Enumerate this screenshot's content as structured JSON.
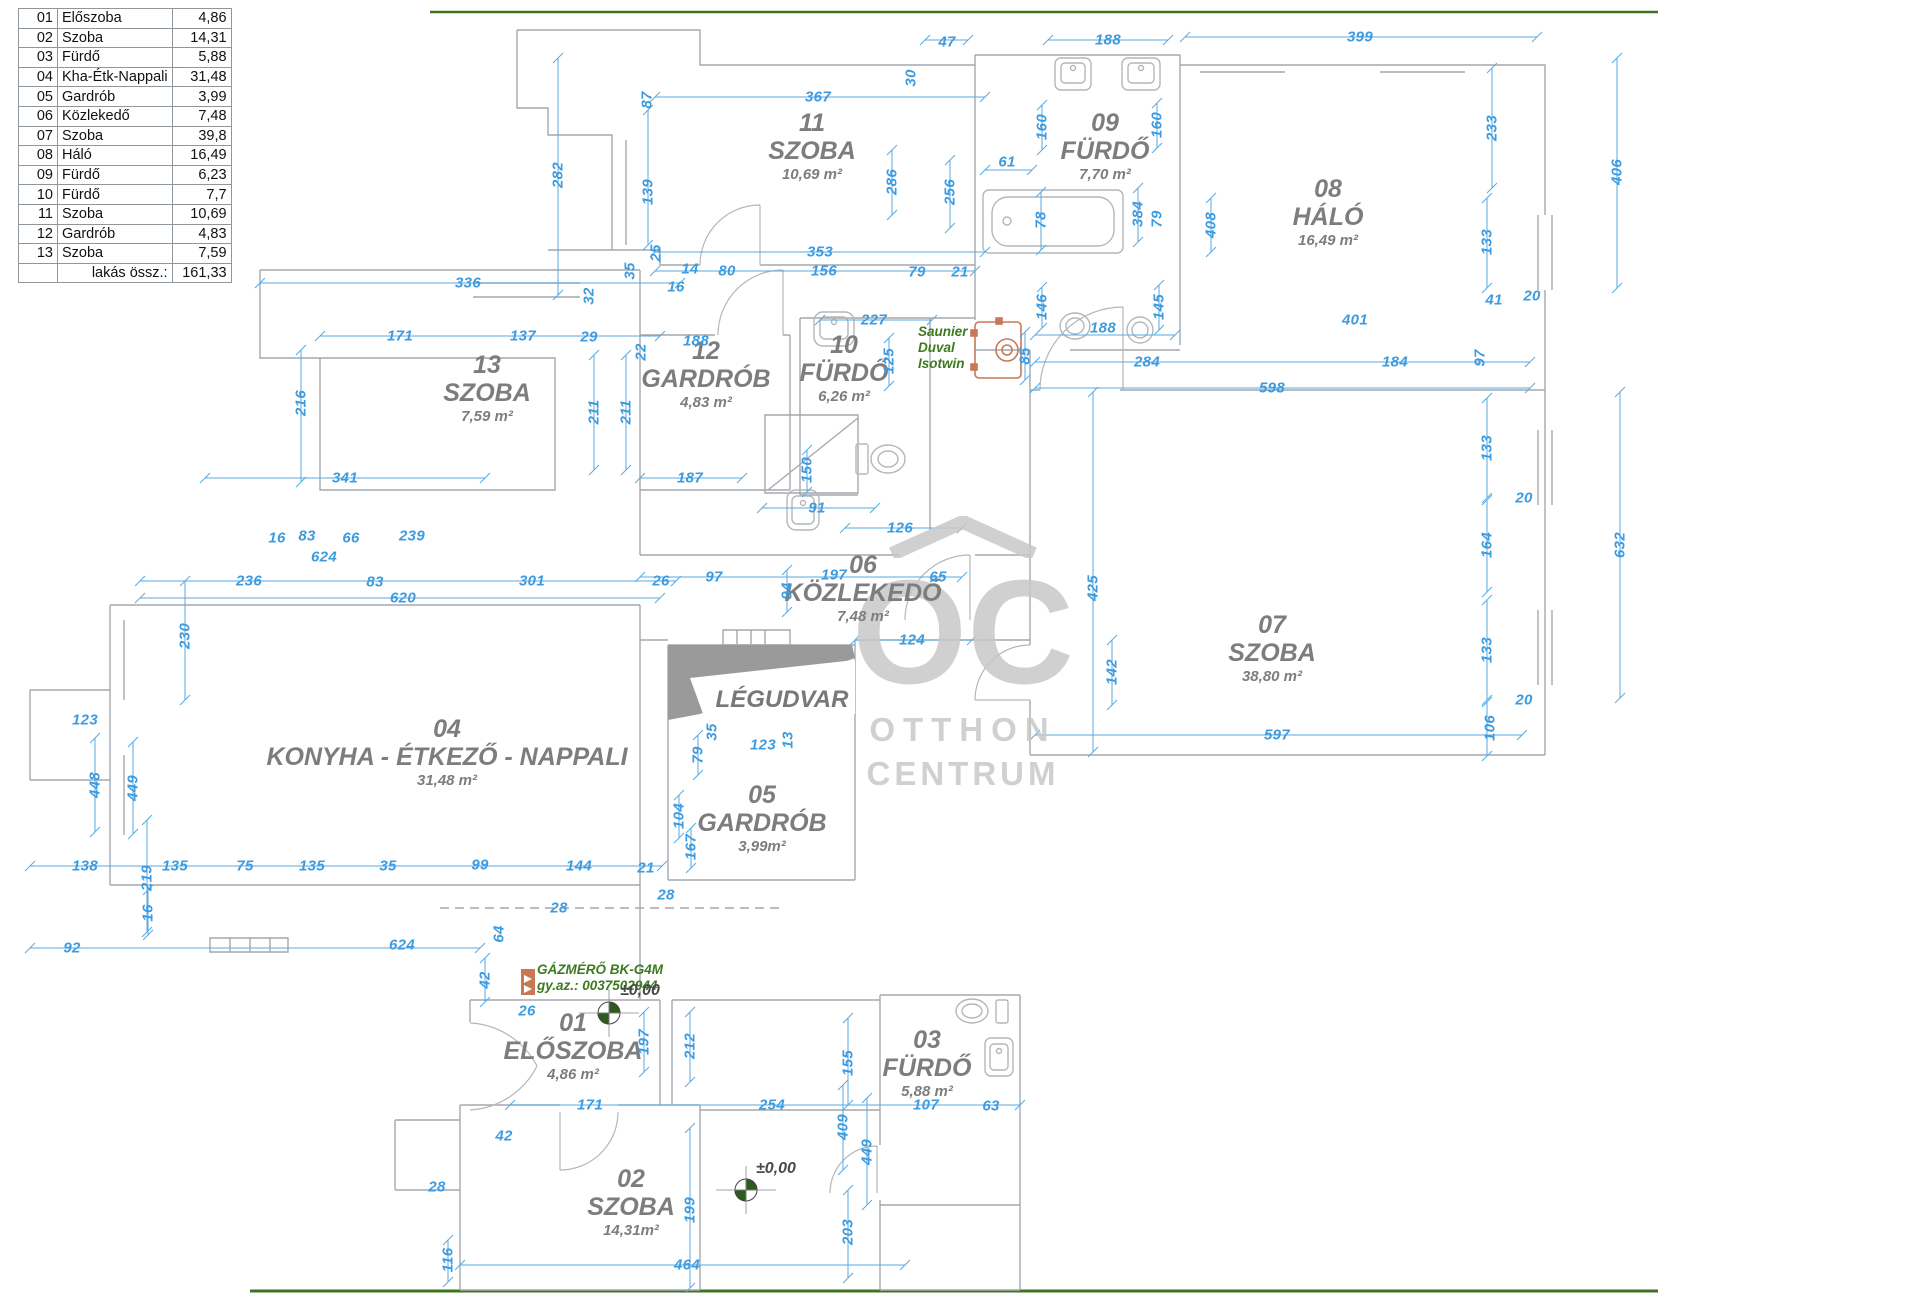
{
  "colors": {
    "dimension": "#3d9be0",
    "dim_line": "#5aaae2",
    "wall": "#a4a9ad",
    "fixture": "#b3b7b9",
    "room_label": "#7d7d7d",
    "green_text": "#3c7a1e",
    "orange": "#c97856",
    "watermark": "#c8c8c8",
    "border_green": "#3f7320",
    "marker_green": "#2d5a1d"
  },
  "table": {
    "rows": [
      {
        "no": "01",
        "name": "Előszoba",
        "area": "4,86"
      },
      {
        "no": "02",
        "name": "Szoba",
        "area": "14,31"
      },
      {
        "no": "03",
        "name": "Fürdő",
        "area": "5,88"
      },
      {
        "no": "04",
        "name": "Kha-Étk-Nappali",
        "area": "31,48"
      },
      {
        "no": "05",
        "name": "Gardrób",
        "area": "3,99"
      },
      {
        "no": "06",
        "name": "Közlekedő",
        "area": "7,48"
      },
      {
        "no": "07",
        "name": "Szoba",
        "area": "39,8"
      },
      {
        "no": "08",
        "name": "Háló",
        "area": "16,49"
      },
      {
        "no": "09",
        "name": "Fürdő",
        "area": "6,23"
      },
      {
        "no": "10",
        "name": "Fürdő",
        "area": "7,7"
      },
      {
        "no": "11",
        "name": "Szoba",
        "area": "10,69"
      },
      {
        "no": "12",
        "name": "Gardrób",
        "area": "4,83"
      },
      {
        "no": "13",
        "name": "Szoba",
        "area": "7,59"
      }
    ],
    "total_label": "lakás össz.:",
    "total_value": "161,33"
  },
  "rooms": [
    {
      "number": "11",
      "name": "SZOBA",
      "area": "10,69 m²",
      "x": 812,
      "y": 110
    },
    {
      "number": "09",
      "name": "FÜRDŐ",
      "area": "7,70 m²",
      "x": 1105,
      "y": 110
    },
    {
      "number": "08",
      "name": "HÁLÓ",
      "area": "16,49 m²",
      "x": 1328,
      "y": 176
    },
    {
      "number": "13",
      "name": "SZOBA",
      "area": "7,59 m²",
      "x": 487,
      "y": 352
    },
    {
      "number": "12",
      "name": "GARDRÓB",
      "area": "4,83 m²",
      "x": 706,
      "y": 338
    },
    {
      "number": "10",
      "name": "FÜRDŐ",
      "area": "6,26 m²",
      "x": 844,
      "y": 332
    },
    {
      "number": "06",
      "name": "KÖZLEKEDŐ",
      "area": "7,48 m²",
      "x": 863,
      "y": 552
    },
    {
      "number": "07",
      "name": "SZOBA",
      "area": "38,80 m²",
      "x": 1272,
      "y": 612
    },
    {
      "number": "04",
      "name": "KONYHA - ÉTKEZŐ - NAPPALI",
      "area": "31,48 m²",
      "x": 447,
      "y": 716
    },
    {
      "number": "05",
      "name": "GARDRÓB",
      "area": "3,99m²",
      "x": 762,
      "y": 782
    },
    {
      "number": "01",
      "name": "ELŐSZOBA",
      "area": "4,86 m²",
      "x": 573,
      "y": 1010
    },
    {
      "number": "03",
      "name": "FÜRDŐ",
      "area": "5,88 m²",
      "x": 927,
      "y": 1027
    },
    {
      "number": "02",
      "name": "SZOBA",
      "area": "14,31m²",
      "x": 631,
      "y": 1166
    }
  ],
  "legudvar": {
    "label": "LÉGUDVAR",
    "x": 782,
    "y": 700
  },
  "watermark": {
    "logo": "OC",
    "line1": "OTTHON",
    "line2": "CENTRUM"
  },
  "green_notes": [
    {
      "lines": [
        "Saunier",
        "Duval",
        "Isotwin"
      ],
      "x": 918,
      "y": 324
    },
    {
      "lines": [
        "GÁZMÉRŐ BK-G4M",
        "gy.az.: 0037502944"
      ],
      "x": 537,
      "y": 962
    }
  ],
  "level_markers": [
    {
      "label": "±0,00",
      "tx": 620,
      "ty": 982,
      "cx": 609,
      "cy": 1013
    },
    {
      "label": "±0,00",
      "tx": 756,
      "ty": 1160,
      "cx": 746,
      "cy": 1190
    }
  ],
  "dimensions": [
    {
      "t": "47",
      "x": 947,
      "y": 42,
      "o": "h"
    },
    {
      "t": "30",
      "x": 911,
      "y": 78,
      "o": "v"
    },
    {
      "t": "188",
      "x": 1108,
      "y": 40,
      "o": "h"
    },
    {
      "t": "399",
      "x": 1360,
      "y": 37,
      "o": "h"
    },
    {
      "t": "87",
      "x": 647,
      "y": 100,
      "o": "v"
    },
    {
      "t": "367",
      "x": 818,
      "y": 97,
      "o": "h"
    },
    {
      "t": "282",
      "x": 558,
      "y": 175,
      "o": "v"
    },
    {
      "t": "139",
      "x": 648,
      "y": 192,
      "o": "v"
    },
    {
      "t": "286",
      "x": 892,
      "y": 182,
      "o": "v"
    },
    {
      "t": "256",
      "x": 950,
      "y": 192,
      "o": "v"
    },
    {
      "t": "160",
      "x": 1042,
      "y": 127,
      "o": "v"
    },
    {
      "t": "160",
      "x": 1157,
      "y": 125,
      "o": "v"
    },
    {
      "t": "61",
      "x": 1007,
      "y": 162,
      "o": "h"
    },
    {
      "t": "78",
      "x": 1041,
      "y": 220,
      "o": "v"
    },
    {
      "t": "384",
      "x": 1138,
      "y": 214,
      "o": "v"
    },
    {
      "t": "79",
      "x": 1157,
      "y": 219,
      "o": "v"
    },
    {
      "t": "408",
      "x": 1211,
      "y": 225,
      "o": "v"
    },
    {
      "t": "406",
      "x": 1617,
      "y": 172,
      "o": "v"
    },
    {
      "t": "233",
      "x": 1492,
      "y": 128,
      "o": "v"
    },
    {
      "t": "133",
      "x": 1487,
      "y": 242,
      "o": "v"
    },
    {
      "t": "146",
      "x": 1042,
      "y": 307,
      "o": "v"
    },
    {
      "t": "145",
      "x": 1159,
      "y": 307,
      "o": "v"
    },
    {
      "t": "188",
      "x": 1103,
      "y": 328,
      "o": "h"
    },
    {
      "t": "85",
      "x": 1025,
      "y": 356,
      "o": "v"
    },
    {
      "t": "284",
      "x": 1147,
      "y": 362,
      "o": "h"
    },
    {
      "t": "401",
      "x": 1355,
      "y": 320,
      "o": "h"
    },
    {
      "t": "41",
      "x": 1494,
      "y": 300,
      "o": "h"
    },
    {
      "t": "20",
      "x": 1532,
      "y": 296,
      "o": "h"
    },
    {
      "t": "184",
      "x": 1395,
      "y": 362,
      "o": "h"
    },
    {
      "t": "97",
      "x": 1480,
      "y": 358,
      "o": "v"
    },
    {
      "t": "598",
      "x": 1272,
      "y": 388,
      "o": "h"
    },
    {
      "t": "353",
      "x": 820,
      "y": 252,
      "o": "h"
    },
    {
      "t": "156",
      "x": 824,
      "y": 271,
      "o": "h"
    },
    {
      "t": "79",
      "x": 917,
      "y": 272,
      "o": "h"
    },
    {
      "t": "21",
      "x": 960,
      "y": 272,
      "o": "h"
    },
    {
      "t": "80",
      "x": 727,
      "y": 271,
      "o": "h"
    },
    {
      "t": "14",
      "x": 690,
      "y": 269,
      "o": "h"
    },
    {
      "t": "16",
      "x": 676,
      "y": 287,
      "o": "h"
    },
    {
      "t": "25",
      "x": 656,
      "y": 253,
      "o": "v"
    },
    {
      "t": "35",
      "x": 630,
      "y": 271,
      "o": "v"
    },
    {
      "t": "227",
      "x": 874,
      "y": 320,
      "o": "h"
    },
    {
      "t": "125",
      "x": 889,
      "y": 361,
      "o": "v"
    },
    {
      "t": "336",
      "x": 468,
      "y": 283,
      "o": "h"
    },
    {
      "t": "32",
      "x": 589,
      "y": 296,
      "o": "v"
    },
    {
      "t": "29",
      "x": 589,
      "y": 337,
      "o": "h"
    },
    {
      "t": "171",
      "x": 400,
      "y": 336,
      "o": "h"
    },
    {
      "t": "137",
      "x": 523,
      "y": 336,
      "o": "h"
    },
    {
      "t": "216",
      "x": 301,
      "y": 403,
      "o": "v"
    },
    {
      "t": "211",
      "x": 594,
      "y": 412,
      "o": "v"
    },
    {
      "t": "211",
      "x": 626,
      "y": 412,
      "o": "v"
    },
    {
      "t": "188",
      "x": 696,
      "y": 341,
      "o": "h"
    },
    {
      "t": "22",
      "x": 641,
      "y": 352,
      "o": "v"
    },
    {
      "t": "341",
      "x": 345,
      "y": 478,
      "o": "h"
    },
    {
      "t": "187",
      "x": 690,
      "y": 478,
      "o": "h"
    },
    {
      "t": "16",
      "x": 277,
      "y": 538,
      "o": "h"
    },
    {
      "t": "83",
      "x": 307,
      "y": 536,
      "o": "h"
    },
    {
      "t": "66",
      "x": 351,
      "y": 538,
      "o": "h"
    },
    {
      "t": "239",
      "x": 412,
      "y": 536,
      "o": "h"
    },
    {
      "t": "624",
      "x": 324,
      "y": 557,
      "o": "h"
    },
    {
      "t": "236",
      "x": 249,
      "y": 581,
      "o": "h"
    },
    {
      "t": "83",
      "x": 375,
      "y": 582,
      "o": "h"
    },
    {
      "t": "301",
      "x": 532,
      "y": 581,
      "o": "h"
    },
    {
      "t": "26",
      "x": 661,
      "y": 581,
      "o": "h"
    },
    {
      "t": "97",
      "x": 714,
      "y": 577,
      "o": "h"
    },
    {
      "t": "620",
      "x": 403,
      "y": 598,
      "o": "h"
    },
    {
      "t": "197",
      "x": 834,
      "y": 575,
      "o": "h"
    },
    {
      "t": "65",
      "x": 938,
      "y": 577,
      "o": "h"
    },
    {
      "t": "94",
      "x": 787,
      "y": 591,
      "o": "v"
    },
    {
      "t": "91",
      "x": 817,
      "y": 508,
      "o": "h"
    },
    {
      "t": "150",
      "x": 807,
      "y": 470,
      "o": "v"
    },
    {
      "t": "126",
      "x": 900,
      "y": 528,
      "o": "h"
    },
    {
      "t": "124",
      "x": 912,
      "y": 640,
      "o": "h"
    },
    {
      "t": "425",
      "x": 1093,
      "y": 588,
      "o": "v"
    },
    {
      "t": "142",
      "x": 1112,
      "y": 672,
      "o": "v"
    },
    {
      "t": "597",
      "x": 1277,
      "y": 735,
      "o": "h"
    },
    {
      "t": "106",
      "x": 1490,
      "y": 728,
      "o": "v"
    },
    {
      "t": "20",
      "x": 1524,
      "y": 700,
      "o": "h"
    },
    {
      "t": "133",
      "x": 1487,
      "y": 650,
      "o": "v"
    },
    {
      "t": "164",
      "x": 1487,
      "y": 545,
      "o": "v"
    },
    {
      "t": "20",
      "x": 1524,
      "y": 498,
      "o": "h"
    },
    {
      "t": "133",
      "x": 1487,
      "y": 448,
      "o": "v"
    },
    {
      "t": "632",
      "x": 1620,
      "y": 545,
      "o": "v"
    },
    {
      "t": "123",
      "x": 85,
      "y": 720,
      "o": "h"
    },
    {
      "t": "448",
      "x": 95,
      "y": 785,
      "o": "v"
    },
    {
      "t": "449",
      "x": 133,
      "y": 788,
      "o": "v"
    },
    {
      "t": "230",
      "x": 185,
      "y": 636,
      "o": "v"
    },
    {
      "t": "219",
      "x": 147,
      "y": 878,
      "o": "v"
    },
    {
      "t": "138",
      "x": 85,
      "y": 866,
      "o": "h"
    },
    {
      "t": "135",
      "x": 175,
      "y": 866,
      "o": "h"
    },
    {
      "t": "75",
      "x": 245,
      "y": 866,
      "o": "h"
    },
    {
      "t": "135",
      "x": 312,
      "y": 866,
      "o": "h"
    },
    {
      "t": "35",
      "x": 388,
      "y": 866,
      "o": "h"
    },
    {
      "t": "99",
      "x": 480,
      "y": 865,
      "o": "h"
    },
    {
      "t": "144",
      "x": 579,
      "y": 866,
      "o": "h"
    },
    {
      "t": "21",
      "x": 646,
      "y": 868,
      "o": "h"
    },
    {
      "t": "16",
      "x": 148,
      "y": 913,
      "o": "v"
    },
    {
      "t": "92",
      "x": 72,
      "y": 948,
      "o": "h"
    },
    {
      "t": "624",
      "x": 402,
      "y": 945,
      "o": "h"
    },
    {
      "t": "64",
      "x": 499,
      "y": 934,
      "o": "v"
    },
    {
      "t": "28",
      "x": 666,
      "y": 895,
      "o": "h"
    },
    {
      "t": "28",
      "x": 559,
      "y": 908,
      "o": "h"
    },
    {
      "t": "104",
      "x": 679,
      "y": 816,
      "o": "v"
    },
    {
      "t": "167",
      "x": 691,
      "y": 847,
      "o": "v"
    },
    {
      "t": "79",
      "x": 698,
      "y": 755,
      "o": "v"
    },
    {
      "t": "123",
      "x": 763,
      "y": 745,
      "o": "h"
    },
    {
      "t": "35",
      "x": 712,
      "y": 732,
      "o": "v"
    },
    {
      "t": "13",
      "x": 788,
      "y": 740,
      "o": "v"
    },
    {
      "t": "42",
      "x": 485,
      "y": 980,
      "o": "v"
    },
    {
      "t": "26",
      "x": 527,
      "y": 1011,
      "o": "h"
    },
    {
      "t": "197",
      "x": 644,
      "y": 1042,
      "o": "v"
    },
    {
      "t": "212",
      "x": 690,
      "y": 1046,
      "o": "v"
    },
    {
      "t": "171",
      "x": 590,
      "y": 1105,
      "o": "h"
    },
    {
      "t": "254",
      "x": 772,
      "y": 1105,
      "o": "h"
    },
    {
      "t": "42",
      "x": 504,
      "y": 1136,
      "o": "h"
    },
    {
      "t": "28",
      "x": 437,
      "y": 1187,
      "o": "h"
    },
    {
      "t": "116",
      "x": 448,
      "y": 1260,
      "o": "v"
    },
    {
      "t": "107",
      "x": 926,
      "y": 1105,
      "o": "h"
    },
    {
      "t": "63",
      "x": 991,
      "y": 1106,
      "o": "h"
    },
    {
      "t": "409",
      "x": 843,
      "y": 1127,
      "o": "v"
    },
    {
      "t": "155",
      "x": 848,
      "y": 1063,
      "o": "v"
    },
    {
      "t": "449",
      "x": 867,
      "y": 1152,
      "o": "v"
    },
    {
      "t": "203",
      "x": 848,
      "y": 1232,
      "o": "v"
    },
    {
      "t": "199",
      "x": 690,
      "y": 1210,
      "o": "v"
    },
    {
      "t": "464",
      "x": 687,
      "y": 1265,
      "o": "h"
    }
  ]
}
